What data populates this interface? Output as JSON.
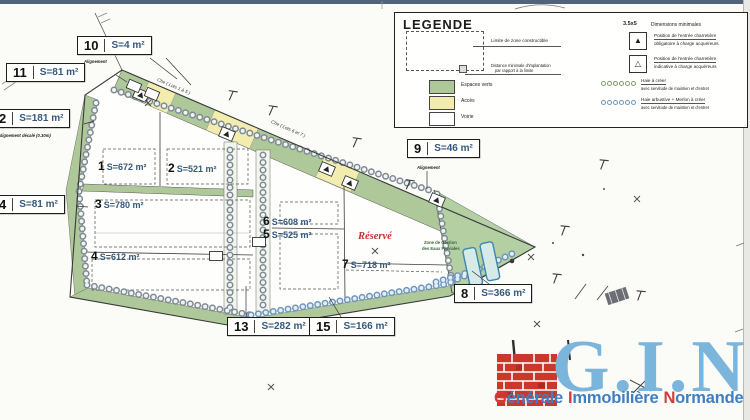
{
  "page": {
    "top_bar_color": "#51627a"
  },
  "legend": {
    "title": "LEGENDE",
    "limite_label": "Limite de zone constructible",
    "distance_label_1": "Distance minimale d'implantation",
    "distance_label_2": "par rapport à la limite",
    "swatches": [
      {
        "label": "Espaces verts",
        "color": "#aec89a"
      },
      {
        "label": "Accès",
        "color": "#f2edae"
      },
      {
        "label": "Voirie",
        "color": "#ffffff"
      }
    ],
    "dims_value": "3.5x5",
    "dims_label": "Dimensions minimales",
    "entree_items": [
      {
        "icon": "filled-triangle",
        "line1": "Position de l'entrée charretière",
        "line2": "obligatoire à charge acquéreurs"
      },
      {
        "icon": "open-triangle",
        "line1": "Position de l'entrée charretière",
        "line2": "indicative à charge acquéreurs"
      }
    ],
    "haie_items": [
      {
        "color": "#7f9e68",
        "line1": "Haie à créer",
        "line2": "avec servitude de maintien et d'entret"
      },
      {
        "color": "#6f95bb",
        "line1": "Haie arbustive + Merlon à créer",
        "line2": "avec servitude de maintien et d'entret"
      }
    ]
  },
  "plan": {
    "parcel_labels": [
      {
        "num": "1",
        "area": "S=672 m²"
      },
      {
        "num": "2",
        "area": "S=521 m²"
      },
      {
        "num": "3",
        "area": "S=780 m²"
      },
      {
        "num": "4",
        "area": "S=612 m²"
      },
      {
        "num": "6",
        "area": "S=608 m²"
      },
      {
        "num": "5",
        "area": "S=525 m²"
      },
      {
        "num": "7",
        "area": "S=718 m²"
      }
    ],
    "boxed_labels": [
      {
        "num": "10",
        "area": "S=4 m²",
        "note": "Alignement"
      },
      {
        "num": "11",
        "area": "S=81 m²",
        "note": ""
      },
      {
        "num": "2",
        "area": "S=181 m²",
        "note": "Alignement décalé (0.30m)"
      },
      {
        "num": "4",
        "area": "S=81 m²",
        "note": ""
      },
      {
        "num": "9",
        "area": "S=46 m²",
        "note": "Alignement"
      },
      {
        "num": "8",
        "area": "S=366 m²",
        "note": ""
      },
      {
        "num": "13",
        "area": "S=282 m²",
        "note": ""
      },
      {
        "num": "15",
        "area": "S=166 m²",
        "note": ""
      }
    ],
    "reserved_label": "Réservé",
    "water_zone_line1": "Zone de Gestion",
    "water_zone_line2": "des Eaux Pluviales",
    "road_label_1": "Che ( Lots 1 à 5 )",
    "road_label_2": "Che ( Lots 6 et 7 )",
    "colors": {
      "green": "#aec89a",
      "yellow": "#f2edae",
      "water": "#d6eae8"
    }
  },
  "logo": {
    "initials": "G.I.N",
    "words": [
      {
        "cap": "G",
        "rest": "énérale"
      },
      {
        "cap": "I",
        "rest": "mmobilière"
      },
      {
        "cap": "N",
        "rest": "ormande"
      }
    ],
    "initials_color": "#7bb5dc",
    "cap_color": "#d43b3b",
    "word_color": "#3f7fc1",
    "brick_color": "#c8392b"
  }
}
